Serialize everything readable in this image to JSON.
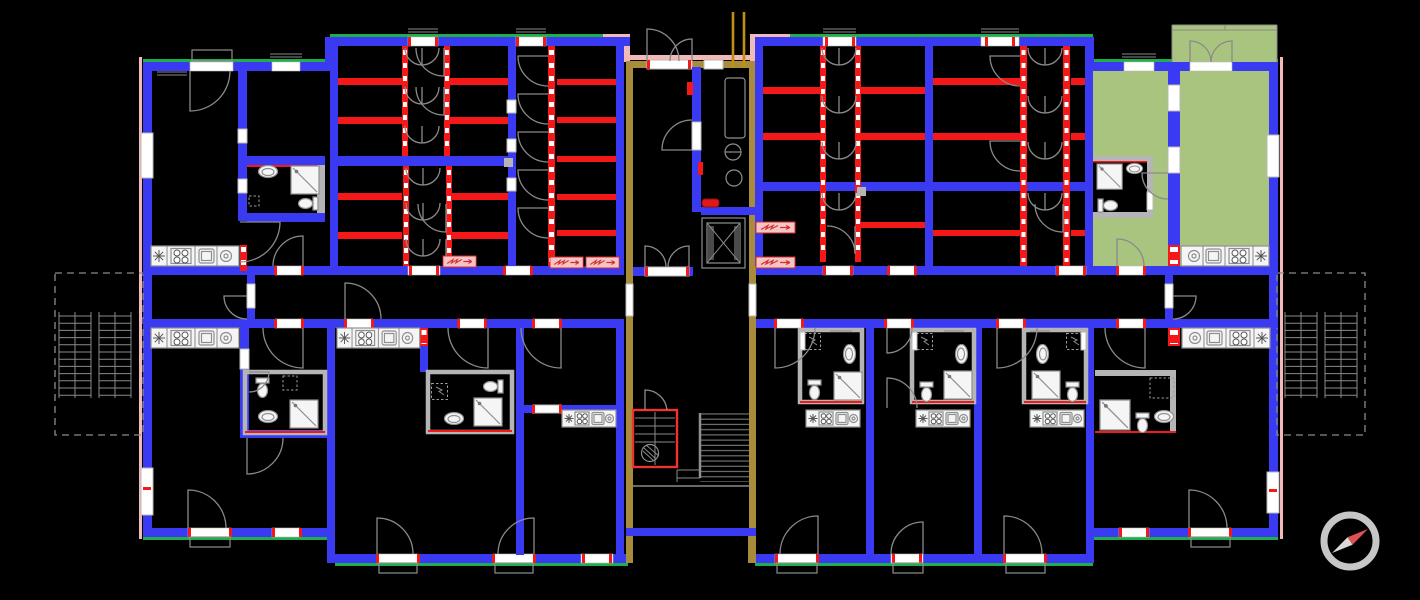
{
  "document": {
    "kind": "floor-plan-drawing",
    "visible_text": []
  },
  "colors": {
    "bg": "#000000",
    "wall-blue": "#3a3af2",
    "wall-red": "#f51818",
    "wall-tan": "#a88c3c",
    "accent-green": "#1fae4e",
    "accent-pink": "#f2b9b9",
    "room-olive": "#a9c47e",
    "fixture-gray": "#8f8f8f",
    "fixture-white": "#f5f5f5",
    "heater-pink": "#f5c4c4",
    "heater-red": "#d23030",
    "stair-gray": "#7a7a7a",
    "utility-yellow": "#c09010",
    "hatch-gray": "#8a8a8a",
    "door-gray": "#8a8a8a",
    "shaft-red": "#ee3333",
    "compass-ring": "#c6c6c6",
    "compass-red": "#e05252",
    "compass-white": "#d9d9d9"
  },
  "icons": [
    {
      "name": "compass-icon",
      "meaning": "north-orientation compass rose, needle pointing north-east"
    }
  ],
  "legend": {
    "blue": "load-bearing walls",
    "red": "partition walls and radiators",
    "tan": "staircase core walls",
    "olive": "highlighted apartment and balcony",
    "dashed-gray": "exterior balcony zones",
    "white": "door and window openings"
  }
}
